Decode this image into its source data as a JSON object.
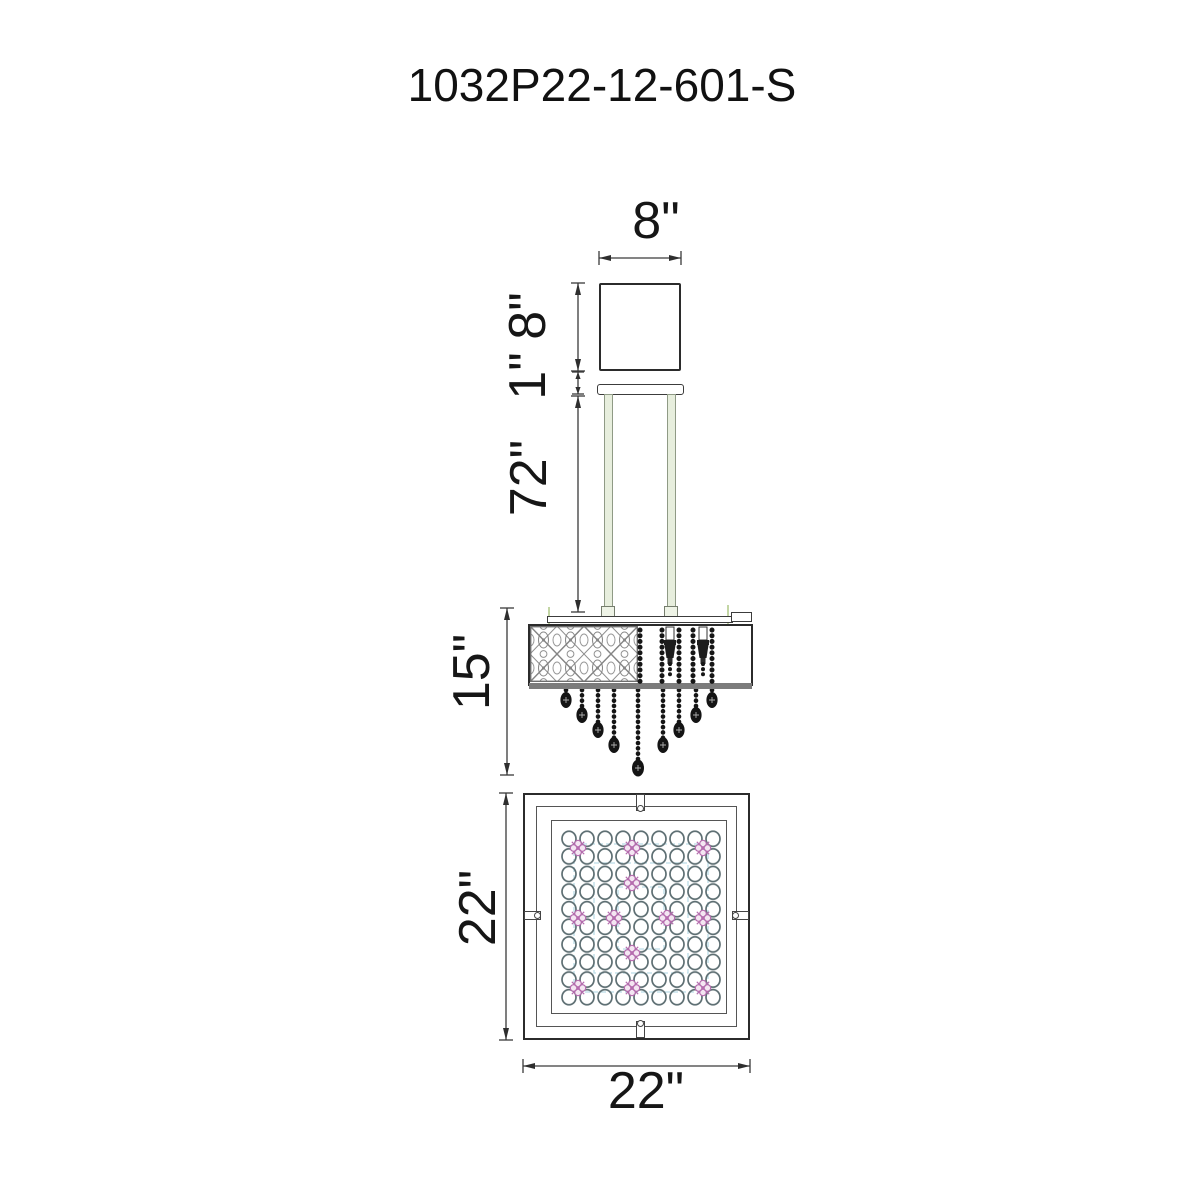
{
  "title": "1032P22-12-601-S",
  "dimensions": {
    "canopy_width": "8\"",
    "canopy_height": "8\"",
    "canopy_gap": "1\"",
    "rod_length": "72\"",
    "body_height": "15\"",
    "plan_height": "22\"",
    "plan_width": "22\""
  },
  "colors": {
    "line": "#2b2b2b",
    "dim_line": "#3a3a3a",
    "rod_fill": "#e7eedd",
    "crystal_black": "#151515",
    "pattern_gray": "#8a8a8a",
    "accent_pink": "#b56cae",
    "accent_blue": "#badce6",
    "accent_green": "#c3d6a4"
  }
}
